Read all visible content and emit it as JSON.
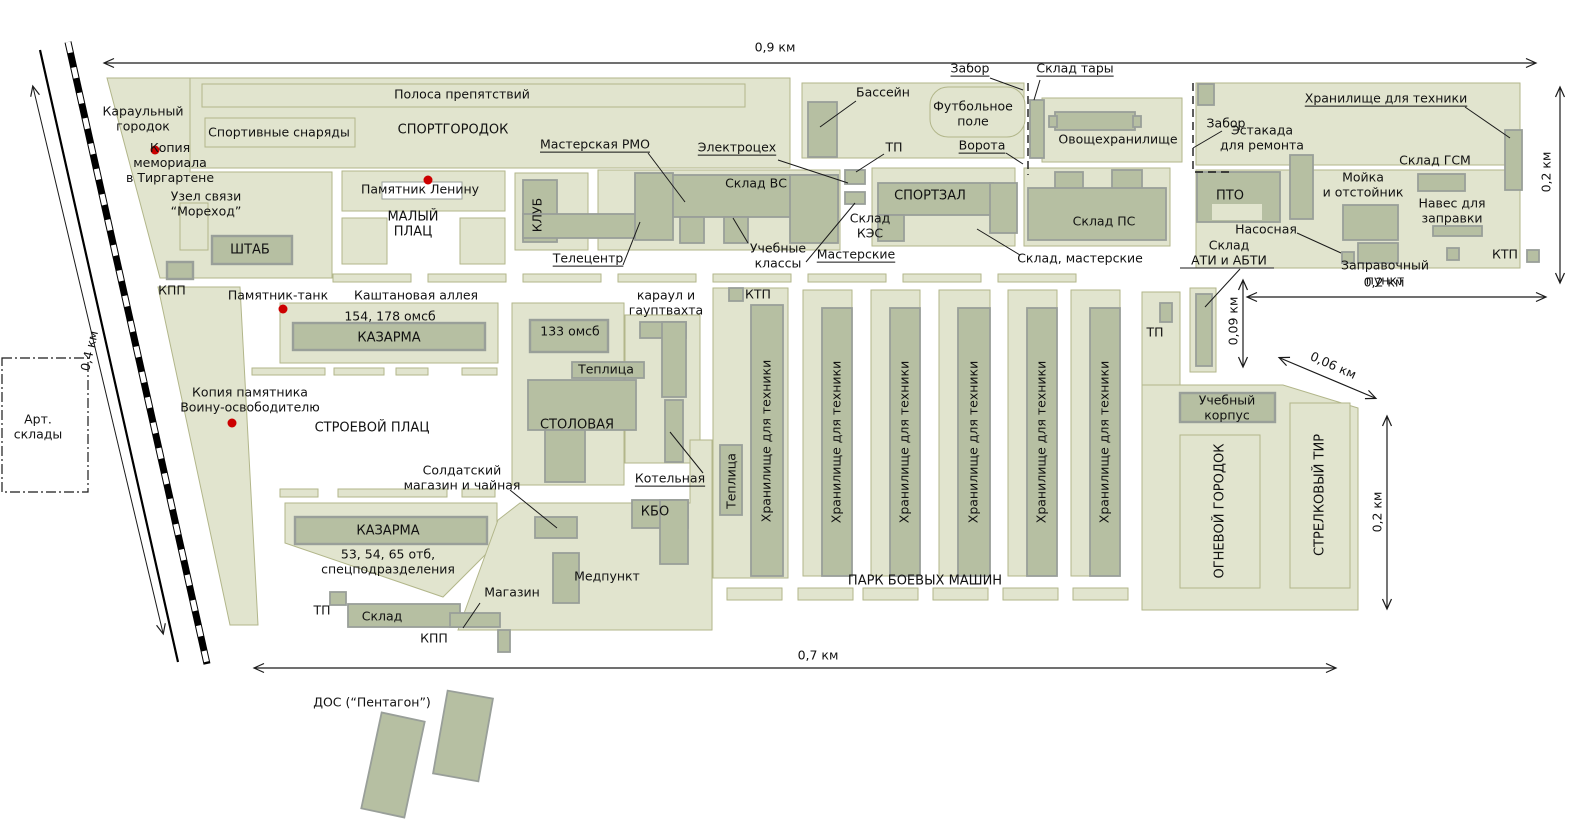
{
  "title": "Схема военного городка (план базы)",
  "colors": {
    "parcel": "#e1e4ce",
    "parcel_stroke": "#b2b68a",
    "building": "#b6bfa2",
    "building_stroke": "#999f99",
    "dot": "#cc0000"
  },
  "labels": [
    {
      "id": "dim-0-9-km",
      "text": "0,9 км",
      "x": 775,
      "y": 48
    },
    {
      "id": "dim-0-2-km-right",
      "text": "0,2 км",
      "x": 1547,
      "y": 172,
      "rot": -90
    },
    {
      "id": "dim-0-2-km-mid",
      "text": "0,2 км",
      "x": 1384,
      "y": 283
    },
    {
      "id": "dim-0-09-km",
      "text": "0,09 км",
      "x": 1234,
      "y": 321,
      "rot": -90
    },
    {
      "id": "dim-0-06-km",
      "text": "0,06 км",
      "x": 1333,
      "y": 366,
      "rot": 24
    },
    {
      "id": "dim-0-2-km-se",
      "text": "0,2 км",
      "x": 1378,
      "y": 512,
      "rot": -90
    },
    {
      "id": "dim-0-7-km",
      "text": "0,7 км",
      "x": 818,
      "y": 656
    },
    {
      "id": "dim-0-4-km",
      "text": "0,4 км",
      "x": 90,
      "y": 351,
      "rot": -77
    },
    {
      "id": "karaulny-gorodok",
      "text": "Караульный\nгородок",
      "x": 143,
      "y": 119
    },
    {
      "id": "polosa-prepyatstviy",
      "text": "Полоса препятствий",
      "x": 462,
      "y": 95
    },
    {
      "id": "sportivnye-snaryady",
      "text": "Спортивные снаряды",
      "x": 279,
      "y": 133
    },
    {
      "id": "sportgorodok",
      "text": "СПОРТГОРОДОК",
      "x": 453,
      "y": 130,
      "size": 13
    },
    {
      "id": "kopiya-memoriala",
      "text": "Копия\nмемориала\nв Тиргартене",
      "x": 170,
      "y": 163
    },
    {
      "id": "uzel-svyazi",
      "text": "Узел связи\n“Мореход”",
      "x": 206,
      "y": 204
    },
    {
      "id": "shtab",
      "text": "ШТАБ",
      "x": 250,
      "y": 250,
      "size": 13
    },
    {
      "id": "kpp-1",
      "text": "КПП",
      "x": 172,
      "y": 291
    },
    {
      "id": "pamyatnik-leninu",
      "text": "Памятник Ленину",
      "x": 420,
      "y": 190
    },
    {
      "id": "maly-plats",
      "text": "МАЛЫЙ\nПЛАЦ",
      "x": 413,
      "y": 225,
      "size": 13
    },
    {
      "id": "masterskaya-rmo",
      "text": "Мастерская РМО",
      "x": 595,
      "y": 145,
      "u": true
    },
    {
      "id": "klub",
      "text": "КЛУБ",
      "x": 538,
      "y": 215,
      "rot": -90
    },
    {
      "id": "teletsentr",
      "text": "Телецентр",
      "x": 588,
      "y": 259,
      "u": true
    },
    {
      "id": "sklad-vs",
      "text": "Склад ВС",
      "x": 756,
      "y": 184
    },
    {
      "id": "elektrotseh",
      "text": "Электроцех",
      "x": 737,
      "y": 148,
      "u": true
    },
    {
      "id": "tp-1",
      "text": "ТП",
      "x": 894,
      "y": 148
    },
    {
      "id": "uchebnye-klassy",
      "text": "Учебные\nклассы",
      "x": 778,
      "y": 256
    },
    {
      "id": "masterskie",
      "text": "Мастерские",
      "x": 856,
      "y": 255,
      "u": true
    },
    {
      "id": "sklad-kes",
      "text": "Склад\nКЭС",
      "x": 870,
      "y": 226
    },
    {
      "id": "sportzal",
      "text": "СПОРТЗАЛ",
      "x": 930,
      "y": 196,
      "size": 13
    },
    {
      "id": "sklad-ps",
      "text": "Склад ПС",
      "x": 1104,
      "y": 222
    },
    {
      "id": "sklad-masterskie",
      "text": "Склад, мастерские",
      "x": 1080,
      "y": 259
    },
    {
      "id": "zabor-1",
      "text": "Забор",
      "x": 970,
      "y": 69,
      "u": true
    },
    {
      "id": "sklad-tary",
      "text": "Склад тары",
      "x": 1075,
      "y": 69,
      "u": true
    },
    {
      "id": "bassein",
      "text": "Бассейн",
      "x": 883,
      "y": 93
    },
    {
      "id": "futbolnoe-pole",
      "text": "Футбольное\nполе",
      "x": 973,
      "y": 114
    },
    {
      "id": "vorota",
      "text": "Ворота",
      "x": 982,
      "y": 146,
      "u": true
    },
    {
      "id": "ovoshchekhranilishche",
      "text": "Овощехранилище",
      "x": 1118,
      "y": 140
    },
    {
      "id": "zabor-2",
      "text": "Забор",
      "x": 1226,
      "y": 124
    },
    {
      "id": "khranilishche-top",
      "text": "Хранилище для техники",
      "x": 1386,
      "y": 99,
      "u": true
    },
    {
      "id": "estakada",
      "text": "Эстакада\nдля ремонта",
      "x": 1262,
      "y": 138
    },
    {
      "id": "moyka",
      "text": "Мойка\nи отстойник",
      "x": 1363,
      "y": 185
    },
    {
      "id": "sklad-gsm",
      "text": "Склад ГСМ",
      "x": 1435,
      "y": 161
    },
    {
      "id": "naves",
      "text": "Навес для\nзаправки",
      "x": 1452,
      "y": 211
    },
    {
      "id": "pto",
      "text": "ПТО",
      "x": 1230,
      "y": 196,
      "size": 13
    },
    {
      "id": "nasosnaya",
      "text": "Насосная",
      "x": 1266,
      "y": 230
    },
    {
      "id": "sklad-ati",
      "text": "Склад\nАТИ и АБТИ",
      "x": 1229,
      "y": 253
    },
    {
      "id": "zapravochny-punkt",
      "text": "Заправочный\nпункт",
      "x": 1385,
      "y": 273
    },
    {
      "id": "ktp-right",
      "text": "КТП",
      "x": 1505,
      "y": 255
    },
    {
      "id": "pamyatnik-tank",
      "text": "Памятник-танк",
      "x": 278,
      "y": 296
    },
    {
      "id": "kashtanovaya-alleya",
      "text": "Каштановая аллея",
      "x": 416,
      "y": 296
    },
    {
      "id": "omsb-154-178",
      "text": "154, 178 омсб",
      "x": 390,
      "y": 317
    },
    {
      "id": "kazarma-1",
      "text": "КАЗАРМА",
      "x": 389,
      "y": 338,
      "size": 13
    },
    {
      "id": "kopiya-pamyatnika",
      "text": "Копия памятника\nВоину-освободителю",
      "x": 250,
      "y": 400
    },
    {
      "id": "stroevoy-plats",
      "text": "СТРОЕВОЙ ПЛАЦ",
      "x": 372,
      "y": 428,
      "size": 13
    },
    {
      "id": "omsb-133",
      "text": "133 омсб",
      "x": 570,
      "y": 332
    },
    {
      "id": "karaul-gauptvakhta",
      "text": "караул и\nгауптвахта",
      "x": 666,
      "y": 303
    },
    {
      "id": "teplitsa-1",
      "text": "Теплица",
      "x": 606,
      "y": 370
    },
    {
      "id": "stolovaya",
      "text": "СТОЛОВАЯ",
      "x": 577,
      "y": 425,
      "size": 13
    },
    {
      "id": "kotelnaya",
      "text": "Котельная",
      "x": 670,
      "y": 479,
      "u": true
    },
    {
      "id": "kbo",
      "text": "КБО",
      "x": 655,
      "y": 512,
      "size": 13
    },
    {
      "id": "medpunkt",
      "text": "Медпункт",
      "x": 607,
      "y": 577
    },
    {
      "id": "soldatsky-magazin",
      "text": "Солдатский\nмагазин и чайная",
      "x": 462,
      "y": 478
    },
    {
      "id": "kazarma-2",
      "text": "КАЗАРМА",
      "x": 388,
      "y": 531,
      "size": 13
    },
    {
      "id": "otb-53-54-65",
      "text": "53, 54, 65 отб,\nспецподразделения",
      "x": 388,
      "y": 562
    },
    {
      "id": "tp-4",
      "text": "ТП",
      "x": 322,
      "y": 611
    },
    {
      "id": "sklad-4",
      "text": "Склад",
      "x": 382,
      "y": 617
    },
    {
      "id": "magazin",
      "text": "Магазин",
      "x": 512,
      "y": 593
    },
    {
      "id": "kpp-2",
      "text": "КПП",
      "x": 434,
      "y": 639
    },
    {
      "id": "dos-pentagon",
      "text": "ДОС (“Пентагон”)",
      "x": 372,
      "y": 703
    },
    {
      "id": "ktp-park",
      "text": "КТП",
      "x": 758,
      "y": 295
    },
    {
      "id": "teplitsa-2",
      "text": "Теплица",
      "x": 732,
      "y": 481,
      "rot": -90
    },
    {
      "id": "khranilishche-1",
      "text": "Хранилище для техники",
      "x": 767,
      "y": 441,
      "rot": -90
    },
    {
      "id": "khranilishche-2",
      "text": "Хранилище для техники",
      "x": 837,
      "y": 442,
      "rot": -90
    },
    {
      "id": "khranilishche-3",
      "text": "Хранилище для техники",
      "x": 905,
      "y": 442,
      "rot": -90
    },
    {
      "id": "khranilishche-4",
      "text": "Хранилище для техники",
      "x": 974,
      "y": 442,
      "rot": -90
    },
    {
      "id": "khranilishche-5",
      "text": "Хранилище для техники",
      "x": 1042,
      "y": 442,
      "rot": -90
    },
    {
      "id": "khranilishche-6",
      "text": "Хранилище для техники",
      "x": 1105,
      "y": 442,
      "rot": -90
    },
    {
      "id": "park-boevykh-mashin",
      "text": "ПАРК БОЕВЫХ МАШИН",
      "x": 925,
      "y": 581,
      "size": 13
    },
    {
      "id": "tp-3",
      "text": "ТП",
      "x": 1155,
      "y": 333
    },
    {
      "id": "uchebny-korpus",
      "text": "Учебный\nкорпус",
      "x": 1227,
      "y": 408
    },
    {
      "id": "ognevoy-gorodok",
      "text": "ОГНЕВОЙ ГОРОДОК",
      "x": 1220,
      "y": 511,
      "rot": -90,
      "size": 13
    },
    {
      "id": "strelkovy-tir",
      "text": "СТРЕЛКОВЫЙ ТИР",
      "x": 1320,
      "y": 495,
      "rot": -90,
      "size": 13
    },
    {
      "id": "art-sklady",
      "text": "Арт.\nсклады",
      "x": 38,
      "y": 427
    }
  ]
}
